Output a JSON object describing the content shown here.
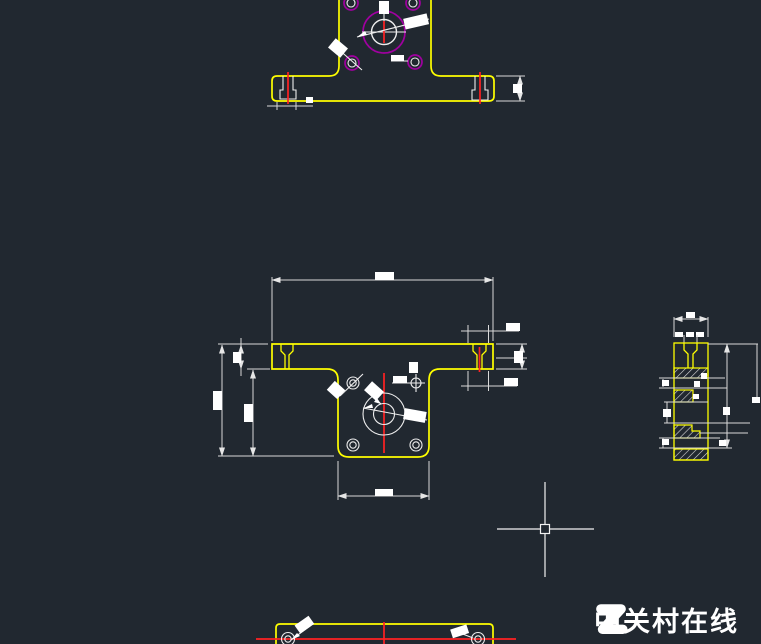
{
  "app": {
    "background_color": "#212830"
  },
  "drawing": {
    "part_outline_color": "#ffff00",
    "dimension_color": "#d9d9d9",
    "centerline_color": "#ff2222",
    "hole_circle_color": "#a000a0",
    "hatch_color": "#d8d8d8"
  },
  "cursor": {
    "color": "#f2f2f2"
  },
  "watermark": {
    "logo_letter": "Z",
    "text": "中关村在线",
    "color": "#ffffff"
  }
}
